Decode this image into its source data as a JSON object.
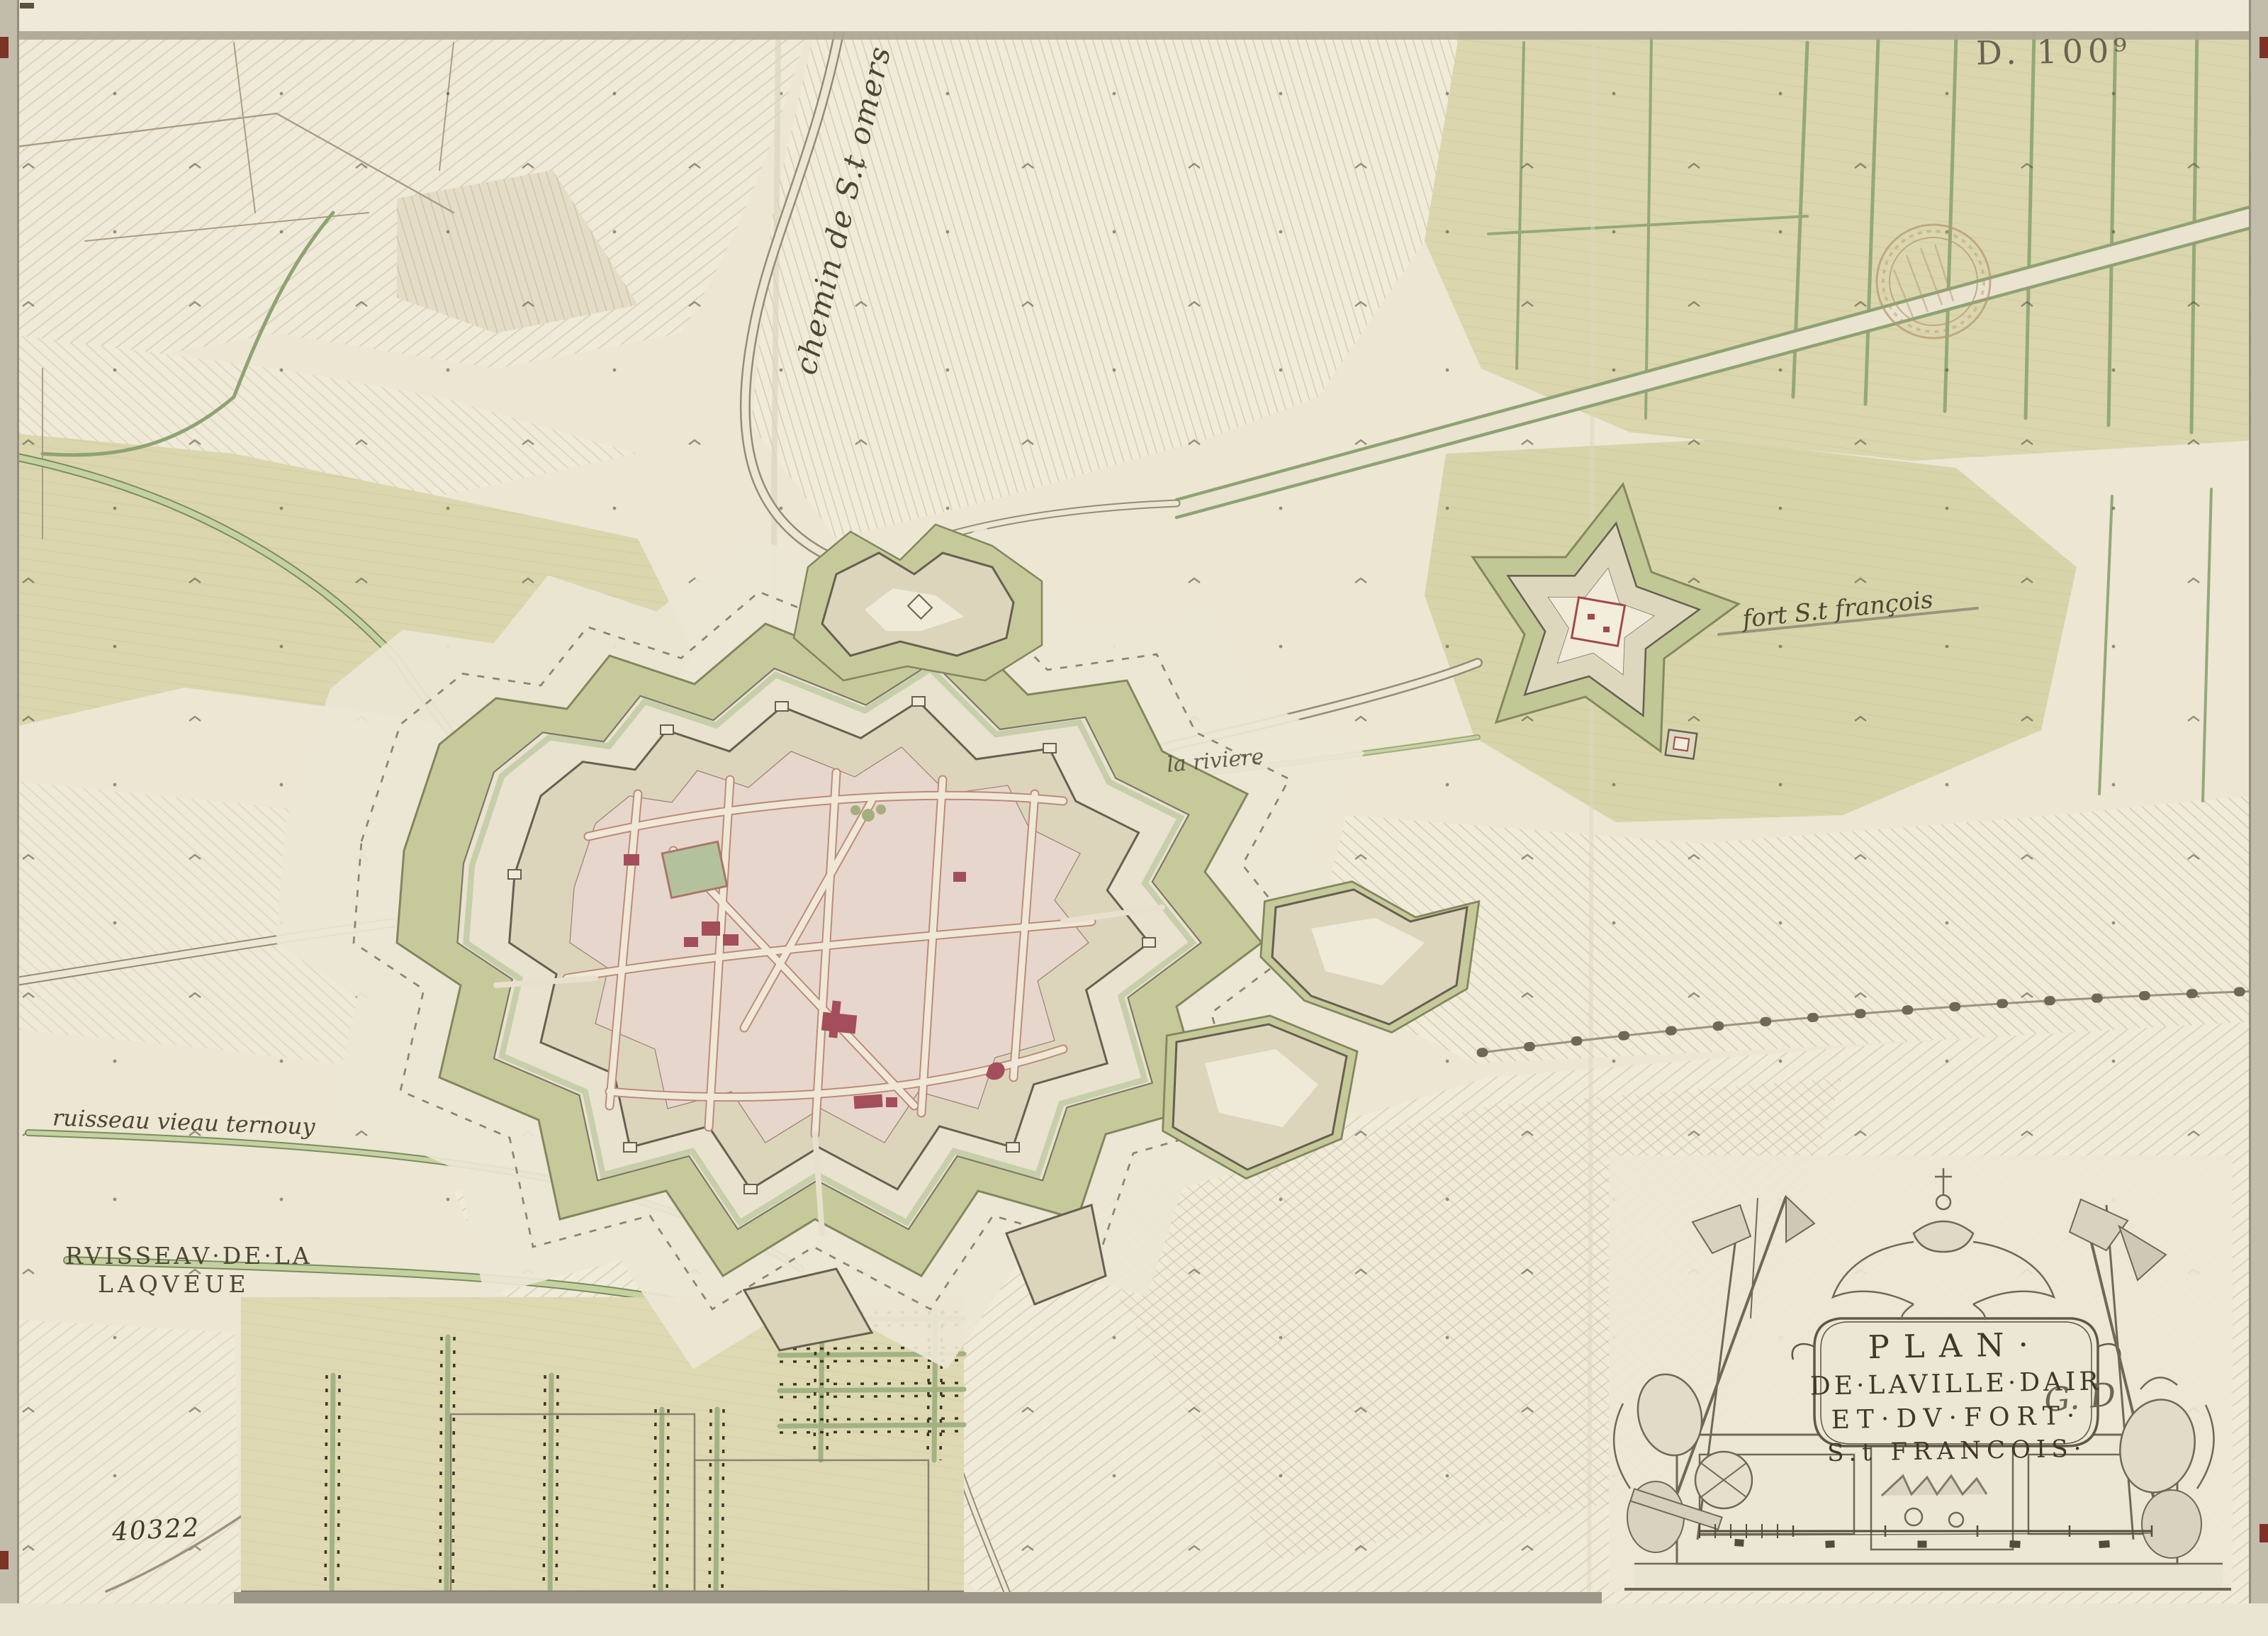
{
  "labels": {
    "shelfmark": "D. 100⁹",
    "chemin_st_omers": "chemin de S.t omers",
    "fort_st_francois": "fort S.t françois",
    "la_riviere": "la riviere",
    "ruisseau_ternouy": "ruisseau vieau ternouy",
    "ruisseau_laqueue_line1": "RVISSEAV·DE·LA",
    "ruisseau_laqueue_line2": "LAQVEUE",
    "inventory_number": "40322"
  },
  "cartouche": {
    "title_line1": "PLAN·",
    "title_line2": "DE·LAVILLE·DAIR",
    "title_line3": "ET·DV·FORT·",
    "title_line4": "S.t FRANCOIS·",
    "signature": "G. D"
  },
  "colors": {
    "paper": "#ece6d3",
    "field_olive": "#dbd6ae",
    "hedge_green": "#95a878",
    "glacis_green": "#c6ca9b",
    "rampart_ink": "#675f4f",
    "town_block_pink": "#e7d6cb",
    "street_red_line": "#bd8a7b",
    "building_red": "#a34e5a",
    "market_green": "#b3c29c",
    "water_green": "#c6d1a2",
    "ink_brown": "#4c4634",
    "mount_grey": "#c2bcab",
    "wax_red": "#7c3326"
  }
}
